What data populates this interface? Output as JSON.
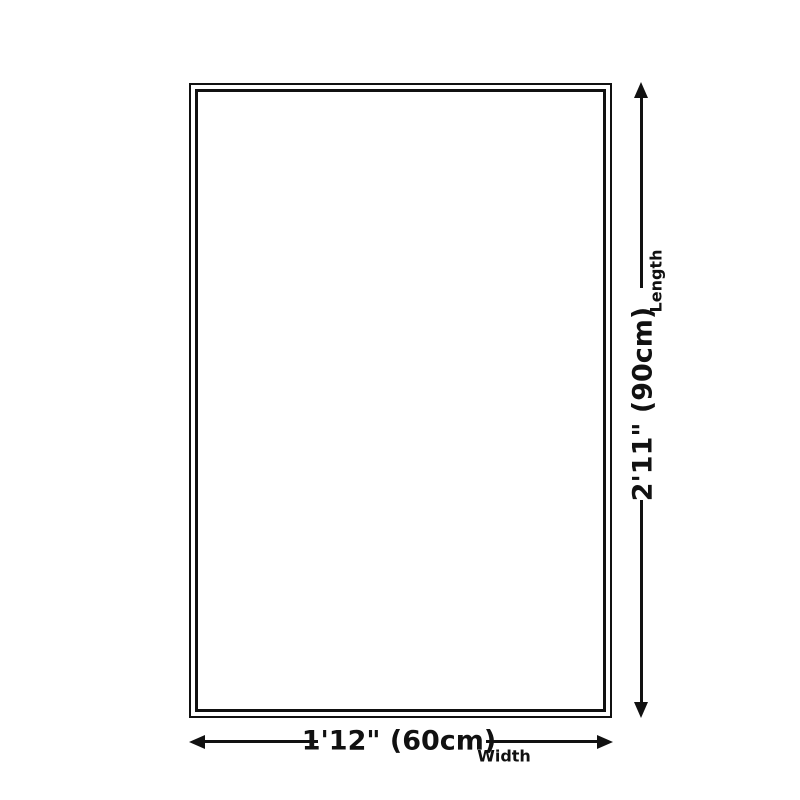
{
  "canvas": {
    "background_color": "#ffffff",
    "line_color": "#111111"
  },
  "diagram": {
    "type": "product-size-diagram",
    "shape": "rectangle-outline-double-border"
  },
  "dimensions": {
    "length": {
      "value": "2'11\" (90cm)",
      "label": "Length"
    },
    "width": {
      "value": "1'12\" (60cm)",
      "label": "Width"
    }
  },
  "icons": {
    "arrow_up": "css-triangle-up",
    "arrow_down": "css-triangle-down",
    "arrow_left": "css-triangle-left",
    "arrow_right": "css-triangle-right"
  }
}
